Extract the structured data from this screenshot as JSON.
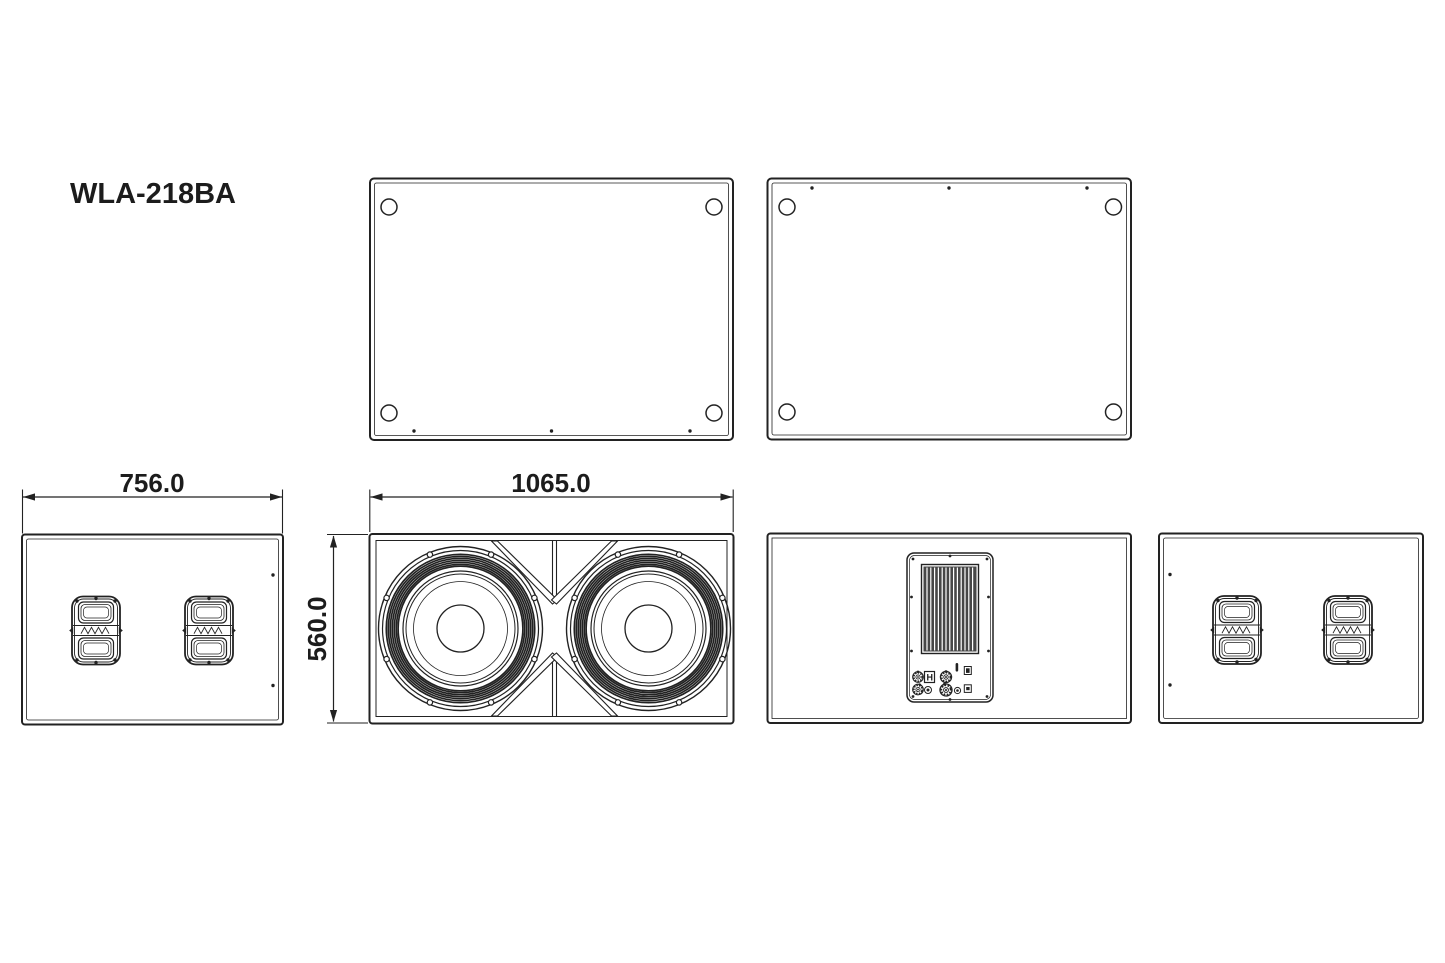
{
  "drawing": {
    "model": "WLA-218BA",
    "dimensions": {
      "width": "1065.0",
      "depth": "756.0",
      "height": "560.0"
    },
    "rear_panel": {
      "power_switch_label": "H"
    },
    "colors": {
      "ink": "#222222",
      "background": "#ffffff"
    }
  }
}
